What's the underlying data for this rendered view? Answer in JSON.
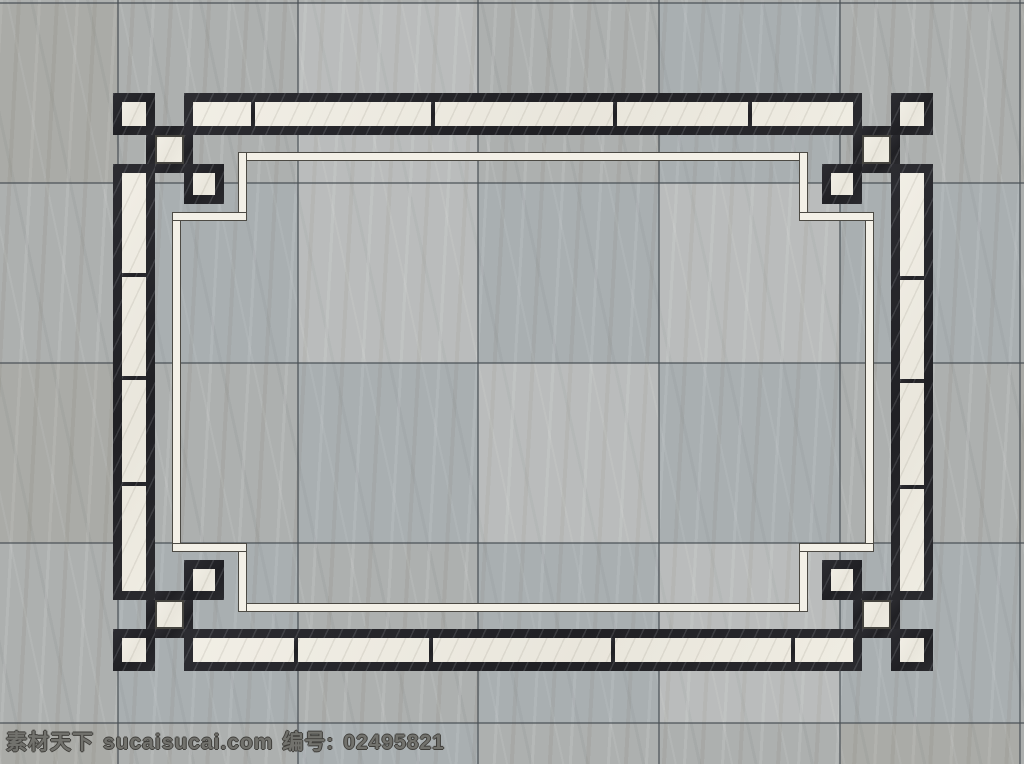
{
  "watermark": {
    "site_name": "素材天下",
    "domain": "sucaisucai.com",
    "id_label": "编号:",
    "id_value": "02495821"
  },
  "palette": {
    "tile_base": "#adb0af",
    "grid_line": "#4b4f53",
    "black_marble": "#242428",
    "white_marble": "#eeebe1",
    "accent_line_fill": "#f3f0e7",
    "accent_line_edge": "#4c4a44"
  },
  "canvas": {
    "w": 1024,
    "h": 764
  },
  "grid": {
    "v_lines": [
      118,
      298,
      478,
      659,
      840,
      1020
    ],
    "h_lines": [
      3,
      183,
      363,
      543,
      723
    ]
  },
  "tiles": {
    "col_edges": [
      0,
      118,
      298,
      478,
      659,
      840,
      1020,
      1024
    ],
    "row_edges": [
      3,
      183,
      363,
      543,
      723,
      764
    ],
    "tints": [
      [
        "w",
        "n",
        "l",
        "n",
        "c",
        "n",
        "w"
      ],
      [
        "n",
        "c",
        "l",
        "c",
        "l",
        "c",
        "n"
      ],
      [
        "w",
        "n",
        "c",
        "l",
        "c",
        "n",
        "w"
      ],
      [
        "n",
        "c",
        "n",
        "c",
        "l",
        "c",
        "n"
      ],
      [
        "w",
        "n",
        "c",
        "n",
        "n",
        "w",
        "n"
      ]
    ]
  },
  "pattern": {
    "border": 9,
    "outer_square_size": 42,
    "inner_square_size": 40,
    "small_square_size": 29,
    "bands": [
      {
        "name": "top-band",
        "x": 184,
        "y": 93,
        "w": 678,
        "h": 42,
        "axis": "x",
        "dividers": [
          253,
          433,
          615,
          750
        ]
      },
      {
        "name": "bottom-band",
        "x": 184,
        "y": 629,
        "w": 678,
        "h": 42,
        "axis": "x",
        "dividers": [
          296,
          431,
          613,
          793
        ]
      },
      {
        "name": "left-band",
        "x": 113,
        "y": 164,
        "w": 42,
        "h": 436,
        "axis": "y",
        "dividers": [
          275,
          378,
          484
        ]
      },
      {
        "name": "right-band",
        "x": 891,
        "y": 164,
        "w": 42,
        "h": 436,
        "axis": "y",
        "dividers": [
          278,
          381,
          487
        ]
      }
    ],
    "outer_squares": [
      {
        "x": 113,
        "y": 93
      },
      {
        "x": 891,
        "y": 93
      },
      {
        "x": 113,
        "y": 629
      },
      {
        "x": 891,
        "y": 629
      }
    ],
    "inner_squares": [
      {
        "x": 184,
        "y": 164
      },
      {
        "x": 822,
        "y": 164
      },
      {
        "x": 184,
        "y": 560
      },
      {
        "x": 822,
        "y": 560
      }
    ],
    "small_squares": [
      {
        "x": 155,
        "y": 135
      },
      {
        "x": 862,
        "y": 135
      },
      {
        "x": 155,
        "y": 600
      },
      {
        "x": 862,
        "y": 600
      }
    ],
    "weave_stripes": [
      {
        "x": 155,
        "y": 126,
        "w": 29,
        "h": 9
      },
      {
        "x": 146,
        "y": 135,
        "w": 9,
        "h": 29
      },
      {
        "x": 184,
        "y": 135,
        "w": 9,
        "h": 29
      },
      {
        "x": 155,
        "y": 164,
        "w": 29,
        "h": 9
      },
      {
        "x": 862,
        "y": 126,
        "w": 29,
        "h": 9
      },
      {
        "x": 891,
        "y": 135,
        "w": 9,
        "h": 29
      },
      {
        "x": 853,
        "y": 135,
        "w": 9,
        "h": 29
      },
      {
        "x": 862,
        "y": 164,
        "w": 29,
        "h": 9
      },
      {
        "x": 155,
        "y": 629,
        "w": 29,
        "h": 9
      },
      {
        "x": 146,
        "y": 600,
        "w": 9,
        "h": 29
      },
      {
        "x": 184,
        "y": 600,
        "w": 9,
        "h": 29
      },
      {
        "x": 155,
        "y": 591,
        "w": 29,
        "h": 9
      },
      {
        "x": 862,
        "y": 629,
        "w": 29,
        "h": 9
      },
      {
        "x": 891,
        "y": 600,
        "w": 9,
        "h": 29
      },
      {
        "x": 853,
        "y": 600,
        "w": 9,
        "h": 29
      },
      {
        "x": 862,
        "y": 591,
        "w": 29,
        "h": 9
      }
    ],
    "inner_line_segments": [
      {
        "x": 243,
        "y": 152,
        "w": 560,
        "h": 9
      },
      {
        "x": 243,
        "y": 603,
        "w": 560,
        "h": 9
      },
      {
        "x": 172,
        "y": 212,
        "w": 9,
        "h": 340
      },
      {
        "x": 865,
        "y": 212,
        "w": 9,
        "h": 340
      },
      {
        "x": 238,
        "y": 152,
        "w": 9,
        "h": 69
      },
      {
        "x": 172,
        "y": 212,
        "w": 75,
        "h": 9
      },
      {
        "x": 799,
        "y": 152,
        "w": 9,
        "h": 69
      },
      {
        "x": 799,
        "y": 212,
        "w": 75,
        "h": 9
      },
      {
        "x": 238,
        "y": 543,
        "w": 9,
        "h": 69
      },
      {
        "x": 172,
        "y": 543,
        "w": 75,
        "h": 9
      },
      {
        "x": 799,
        "y": 543,
        "w": 9,
        "h": 69
      },
      {
        "x": 799,
        "y": 543,
        "w": 75,
        "h": 9
      }
    ]
  }
}
